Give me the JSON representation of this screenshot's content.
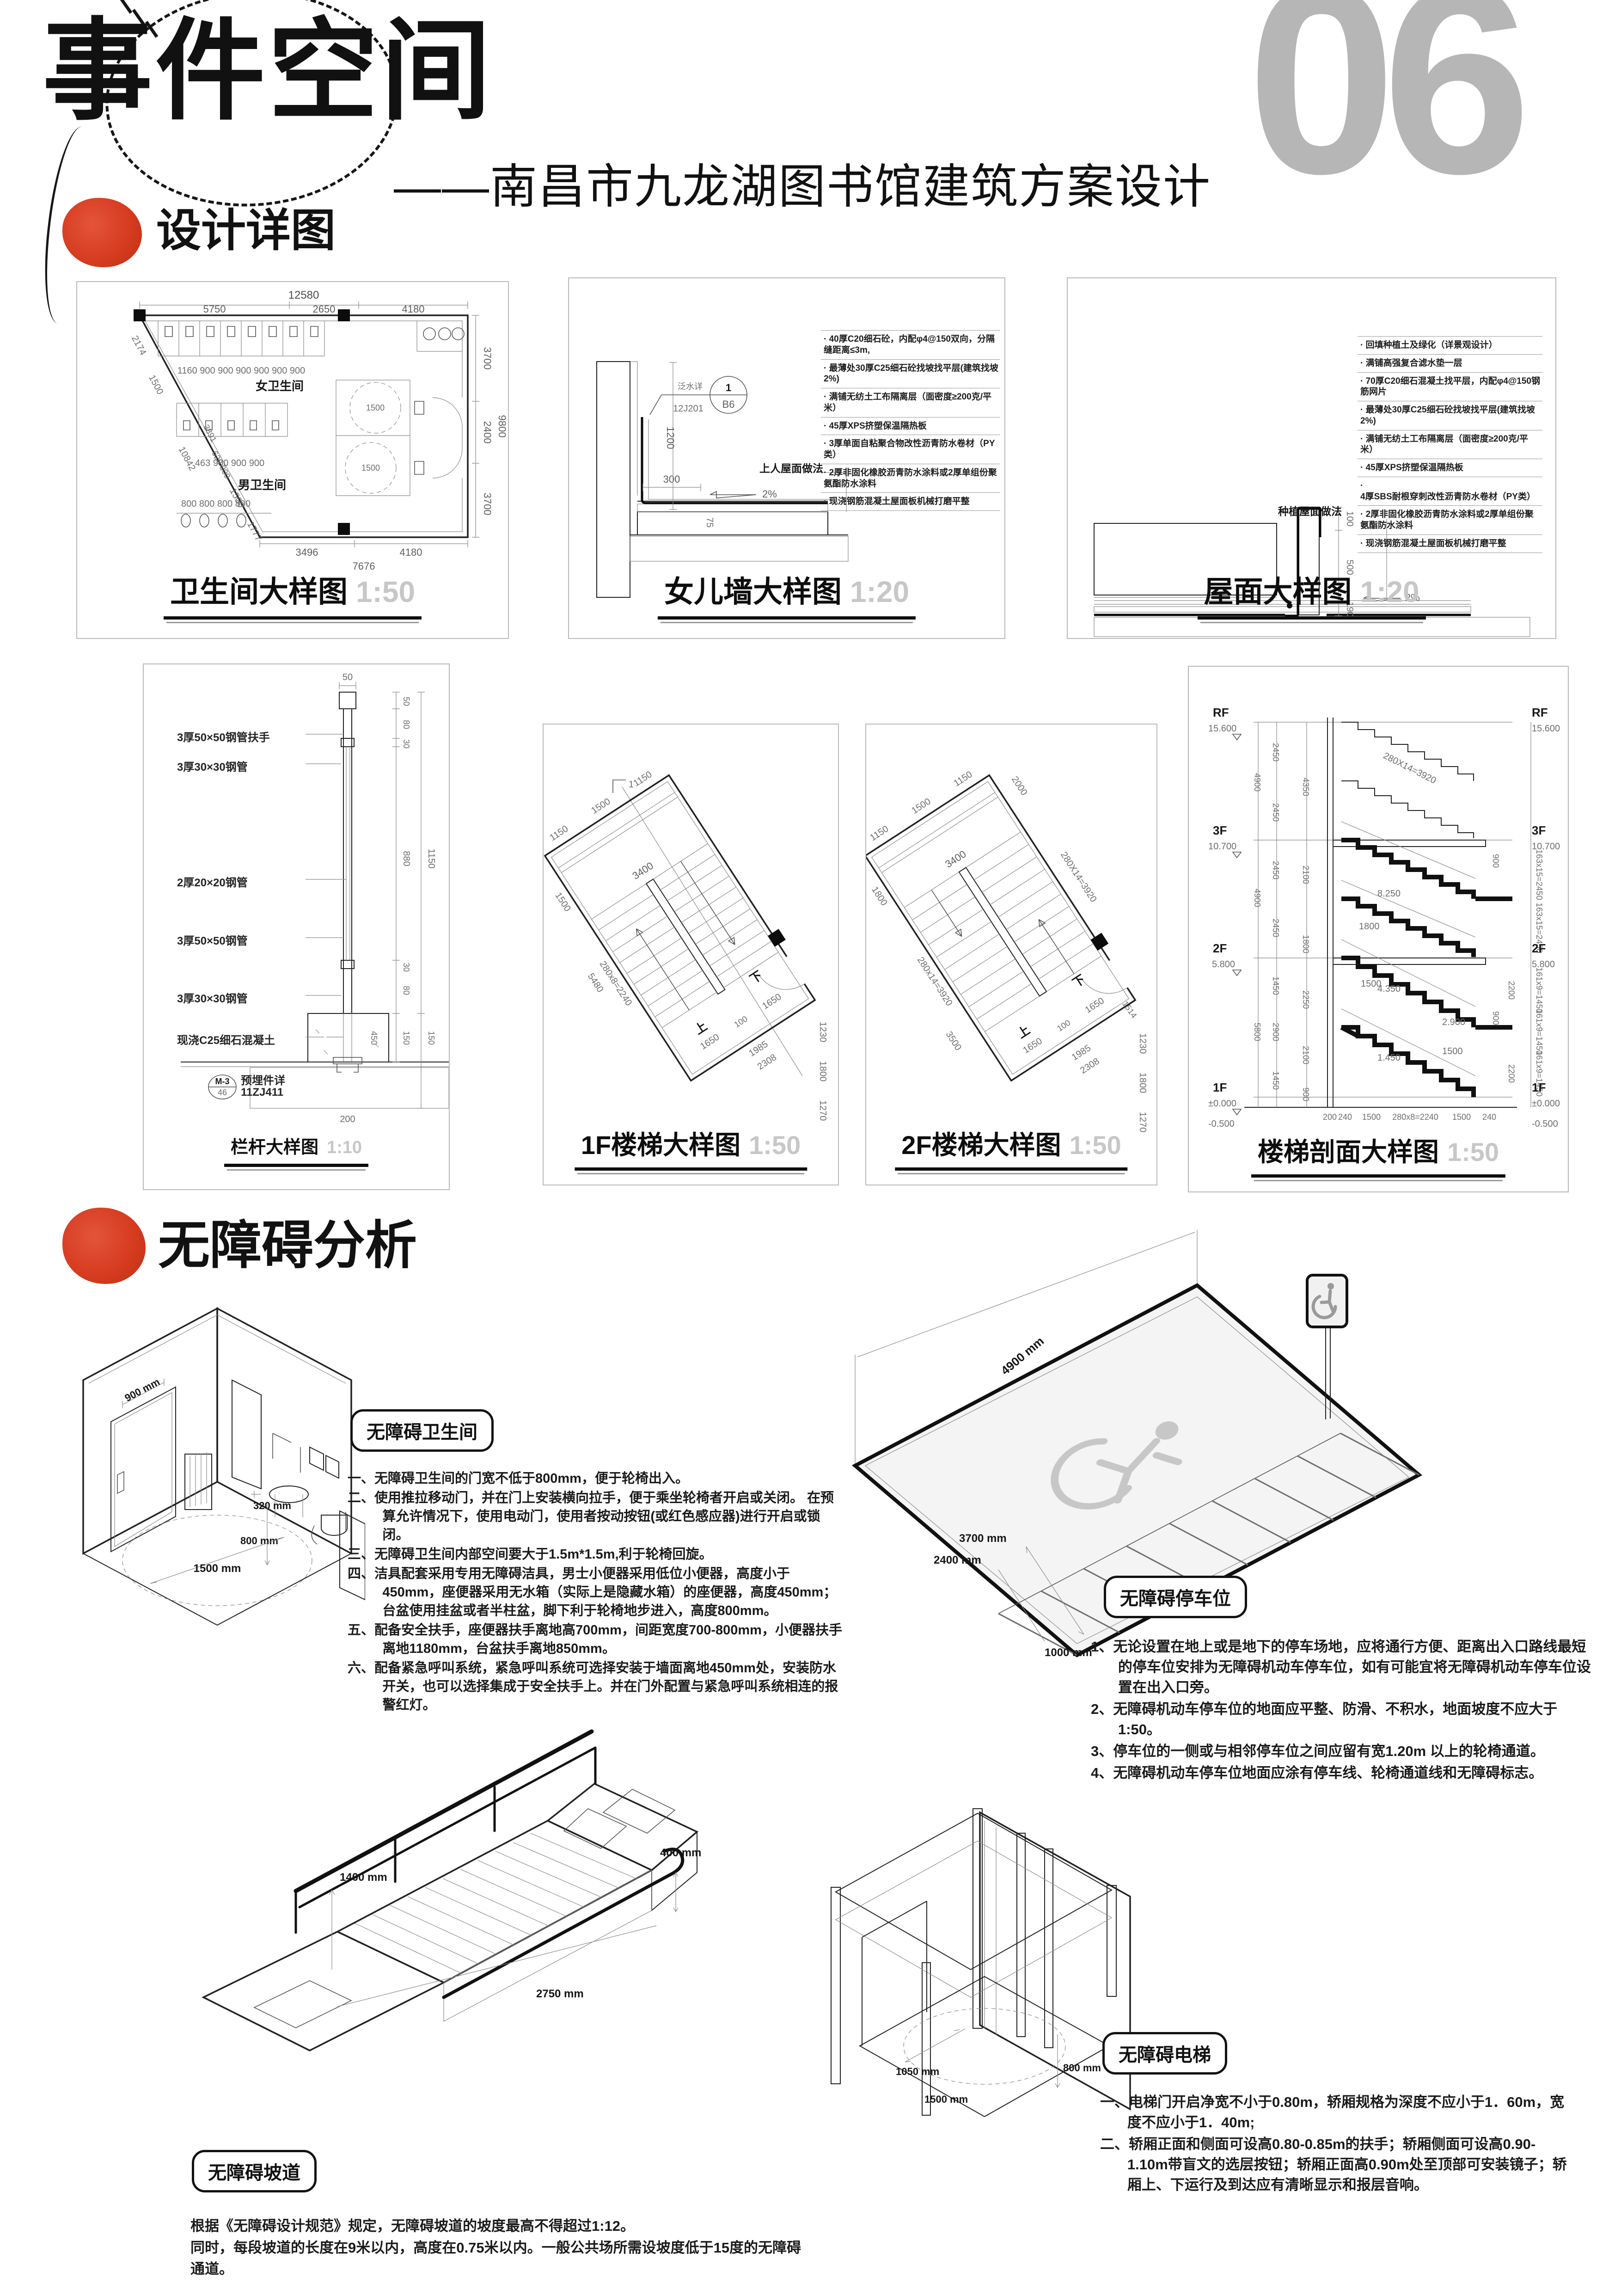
{
  "page_number": "06",
  "header": {
    "title": "事件空间",
    "subtitle": "——南昌市九龙湖图书馆建筑方案设计"
  },
  "sections": {
    "details_title": "设计详图",
    "access_title": "无障碍分析"
  },
  "toilet_plan": {
    "title": "卫生间大样图",
    "scale": "1:50",
    "female_label": "女卫生间",
    "male_label": "男卫生间",
    "turn_circle": "1500",
    "dim_top_total": "12580",
    "dims_top": [
      "5750",
      "2650",
      "4180"
    ],
    "dims_left": [
      "2174",
      "1500",
      "10842",
      "3891",
      "620 800",
      "1500",
      "1777"
    ],
    "dims_right": [
      "3700",
      "2400",
      "3700"
    ],
    "dim_right_total": "9800",
    "dims_bottom": [
      "3496",
      "4180"
    ],
    "dim_bottom_total": "7676",
    "dims_stalls_female": "1160  900  900  900  900  900  900",
    "dims_stalls_male": "463  900  900  900",
    "dims_urinals": "800  800  800  800"
  },
  "parapet": {
    "title": "女儿墙大样图",
    "scale": "1:20",
    "system_label": "上人屋面做法",
    "flashing_ref": "泛水详",
    "ref_code": "12J201",
    "ref_no": "1",
    "ref_cell": "B6",
    "dim_height": "1200",
    "dim_width": "300",
    "dim_lap": "75",
    "slope": "2%",
    "notes": [
      "40厚C20细石砼，内配φ4@150双向，分隔缝距离≤3m,",
      "最薄处30厚C25细石砼找坡找平层(建筑找坡2%)",
      "满铺无纺土工布隔离层（面密度≥200克/平米）",
      "45厚XPS挤塑保温隔热板",
      "3厚单面自粘聚合物改性沥青防水卷材（PY类）",
      "2厚非固化橡胶沥青防水涂料或2厚单组份聚氨酯防水涂料",
      "现浇钢筋混凝土屋面板机械打磨平整"
    ]
  },
  "roof": {
    "title": "屋面大样图",
    "scale": "1:20",
    "system_label": "种植屋面做法",
    "dim_curb_top": "100",
    "dim_curb": "500",
    "dim_slab": "190",
    "slope": "2%",
    "notes": [
      "回填种植土及绿化（详景观设计）",
      "满铺高强复合滤水垫一层",
      "70厚C20细石混凝土找平层，内配φ4@150钢筋网片",
      "最薄处30厚C25细石砼找坡找平层(建筑找坡2%)",
      "满铺无纺土工布隔离层（面密度≥200克/平米）",
      "45厚XPS挤塑保温隔热板",
      "4厚SBS耐根穿刺改性沥青防水卷材（PY类）",
      "2厚非固化橡胶沥青防水涂料或2厚单组份聚氨酯防水涂料",
      "现浇钢筋混凝土屋面板机械打磨平整"
    ]
  },
  "railing": {
    "title": "栏杆大样图",
    "scale": "1:10",
    "labels": [
      "3厚50×50钢管扶手",
      "3厚30×30钢管",
      "2厚20×20钢管",
      "3厚50×50钢管",
      "3厚30×30钢管",
      "现浇C25细石混凝土",
      "预埋件详",
      "11ZJ411"
    ],
    "ref_tag": "M-3",
    "ref_no": "46",
    "dim_top": "50",
    "dims_right_top": [
      "50",
      "80",
      "30"
    ],
    "dim_mid": "880",
    "dim_total": "1150",
    "dims_right_bottom": [
      "30",
      "80"
    ],
    "dims_base": [
      "150",
      "150"
    ],
    "dim_base_inner": "450",
    "dim_embed": "200"
  },
  "stair_1f": {
    "title": "1F楼梯大样图",
    "scale": "1:50",
    "up": "上",
    "down": "下",
    "sec_mark": "1",
    "dims_top": [
      "1150",
      "1500",
      "1150"
    ],
    "dim_width": "3400",
    "dims_left": [
      "1500",
      "280x8=2240",
      "5480"
    ],
    "dims_mid": [
      "1650",
      "100",
      "1650"
    ],
    "dims_right": [
      "1230",
      "1800",
      "1270"
    ],
    "dims_bottom": [
      "1985",
      "2308"
    ]
  },
  "stair_2f": {
    "title": "2F楼梯大样图",
    "scale": "1:50",
    "up": "上",
    "down": "下",
    "dims_top": [
      "1150",
      "1500",
      "1150"
    ],
    "dim_width": "3400",
    "dims_left": [
      "1800",
      "280x14=3920",
      "3500"
    ],
    "dims_right_edge": [
      "2000",
      "280X14=3920"
    ],
    "dims_mid": [
      "1650",
      "100",
      "1650"
    ],
    "dims_right": [
      "1514",
      "1230",
      "1800",
      "1270"
    ],
    "dims_bottom": [
      "1985",
      "2308"
    ]
  },
  "stair_section": {
    "title": "楼梯剖面大样图",
    "scale": "1:50",
    "levels": [
      {
        "name": "RF",
        "elev": "15.600"
      },
      {
        "name": "3F",
        "elev": "10.700"
      },
      {
        "name": "2F",
        "elev": "5.800"
      },
      {
        "name": "1F",
        "elev": "±0.000"
      }
    ],
    "elev_base": "-0.500",
    "flight_note": "280X14=3920",
    "annos": {
      "a1": "1800",
      "a2": "8.250",
      "a3": "4.350",
      "a4": "2.900",
      "a5": "1.450",
      "b1": "1500",
      "b2": "1500",
      "c1": "900",
      "c2": "900",
      "d1": "2200",
      "d2": "2200"
    },
    "dims_left_outer": [
      "4900",
      "4900",
      "5800"
    ],
    "dims_left_inner": [
      "2450",
      "2450",
      "2450",
      "2450",
      "1450",
      "2900",
      "1450"
    ],
    "dims_shaft": [
      "4350",
      "2100",
      "1800",
      "2250",
      "2100",
      "900"
    ],
    "dims_right": [
      "163x15=2450",
      "163x15=2450",
      "161x9=1450",
      "161x9=1450",
      "161x9=1450"
    ],
    "dims_bottom": [
      "200",
      "240",
      "1500",
      "280x8=2240",
      "1500",
      "240"
    ]
  },
  "access_toilet": {
    "badge": "无障碍卫生间",
    "dims": {
      "door": "900 mm",
      "basin": "320 mm",
      "basin_h": "800 mm",
      "circle": "1500 mm"
    },
    "items": [
      "一、无障碍卫生间的门宽不低于800mm，便于轮椅出入。",
      "二、使用推拉移动门，并在门上安装横向拉手，便于乘坐轮椅者开启或关闭。 在预算允许情况下，使用电动门，使用者按动按钮(或红色感应器)进行开启或锁闭。",
      "三、无障碍卫生间内部空间要大于1.5m*1.5m,利于轮椅回旋。",
      "四、洁具配套采用专用无障碍洁具，男士小便器采用低位小便器，高度小于450mm，座便器采用无水箱（实际上是隐藏水箱）的座便器，高度450mm；台盆使用挂盆或者半柱盆，脚下利于轮椅地步进入，高度800mm。",
      "五、配备安全扶手，座便器扶手离地高700mm，间距宽度700-800mm，小便器扶手离地1180mm，台盆扶手离地850mm。",
      "六、配备紧急呼叫系统，紧急呼叫系统可选择安装于墙面离地450mm处，安装防水开关，也可以选择集成于安全扶手上。并在门外配置与紧急呼叫系统相连的报警红灯。"
    ]
  },
  "access_parking": {
    "badge": "无障碍停车位",
    "dims": {
      "length": "4900 mm",
      "depth": "3700 mm",
      "width": "2400 mm",
      "aisle": "1000 mm"
    },
    "items": [
      "1、无论设置在地上或是地下的停车场地，应将通行方便、距离出入口路线最短的停车位安排为无障碍机动车停车位，如有可能宜将无障碍机动车停车位设置在出入口旁。",
      "2、无障碍机动车停车位的地面应平整、防滑、不积水，地面坡度不应大于1:50。",
      "3、停车位的一侧或与相邻停车位之间应留有宽1.20m 以上的轮椅通道。",
      "4、无障碍机动车停车位地面应涂有停车线、轮椅通道线和无障碍标志。"
    ]
  },
  "access_ramp": {
    "badge": "无障碍坡道",
    "dims": {
      "rail": "1400 mm",
      "height": "400 mm",
      "length": "2750 mm"
    },
    "lines": [
      "根据《无障碍设计规范》规定，无障碍坡道的坡度最高不得超过1:12。",
      "同时，每段坡道的长度在9米以内，高度在0.75米以内。一般公共场所需设坡度低于15度的无障碍通道。"
    ]
  },
  "access_elevator": {
    "badge": "无障碍电梯",
    "dims": {
      "door": "1050 mm",
      "circle": "1500 mm",
      "width": "800 mm"
    },
    "items": [
      "一、电梯门开启净宽不小于0.80m，轿厢规格为深度不应小于1．60m，宽度不应小于1．40m;",
      "二、轿厢正面和侧面可设高0.80-0.85m的扶手；轿厢侧面可设高0.90-1.10m带盲文的选层按钮；轿厢正面高0.90m处至顶部可安装镜子；轿厢上、下运行及到达应有清晰显示和报层音响。"
    ]
  },
  "colors": {
    "accent_red": "#d63c20",
    "page_number_gray": "#b6b6b6",
    "line_dark": "#222222",
    "line_gray": "#8a8a8a"
  }
}
